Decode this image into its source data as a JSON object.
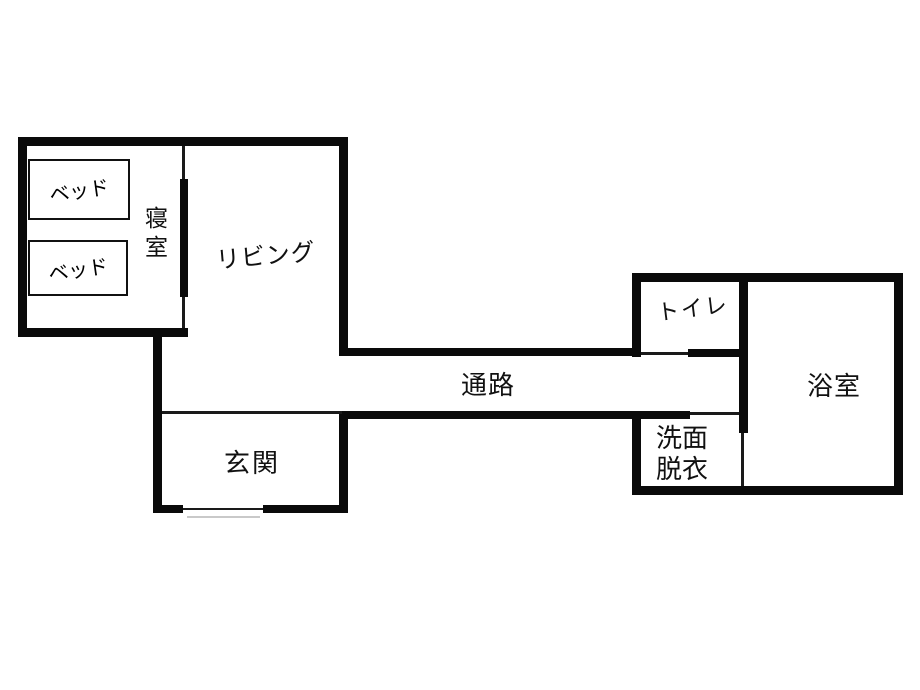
{
  "diagram": {
    "type": "floor-plan",
    "colors": {
      "wall": "#0a0a0a",
      "background": "#ffffff",
      "step_line": "#c9c9c9"
    },
    "rooms": {
      "bedroom": {
        "label": "寝室"
      },
      "living": {
        "label": "リビング"
      },
      "corridor": {
        "label": "通路"
      },
      "entrance": {
        "label": "玄関"
      },
      "toilet": {
        "label": "トイレ"
      },
      "bathroom": {
        "label": "浴室"
      },
      "washroom": {
        "label": "洗面\n脱衣"
      }
    },
    "furniture": {
      "bed1": {
        "label": "ベッド"
      },
      "bed2": {
        "label": "ベッド"
      }
    }
  }
}
